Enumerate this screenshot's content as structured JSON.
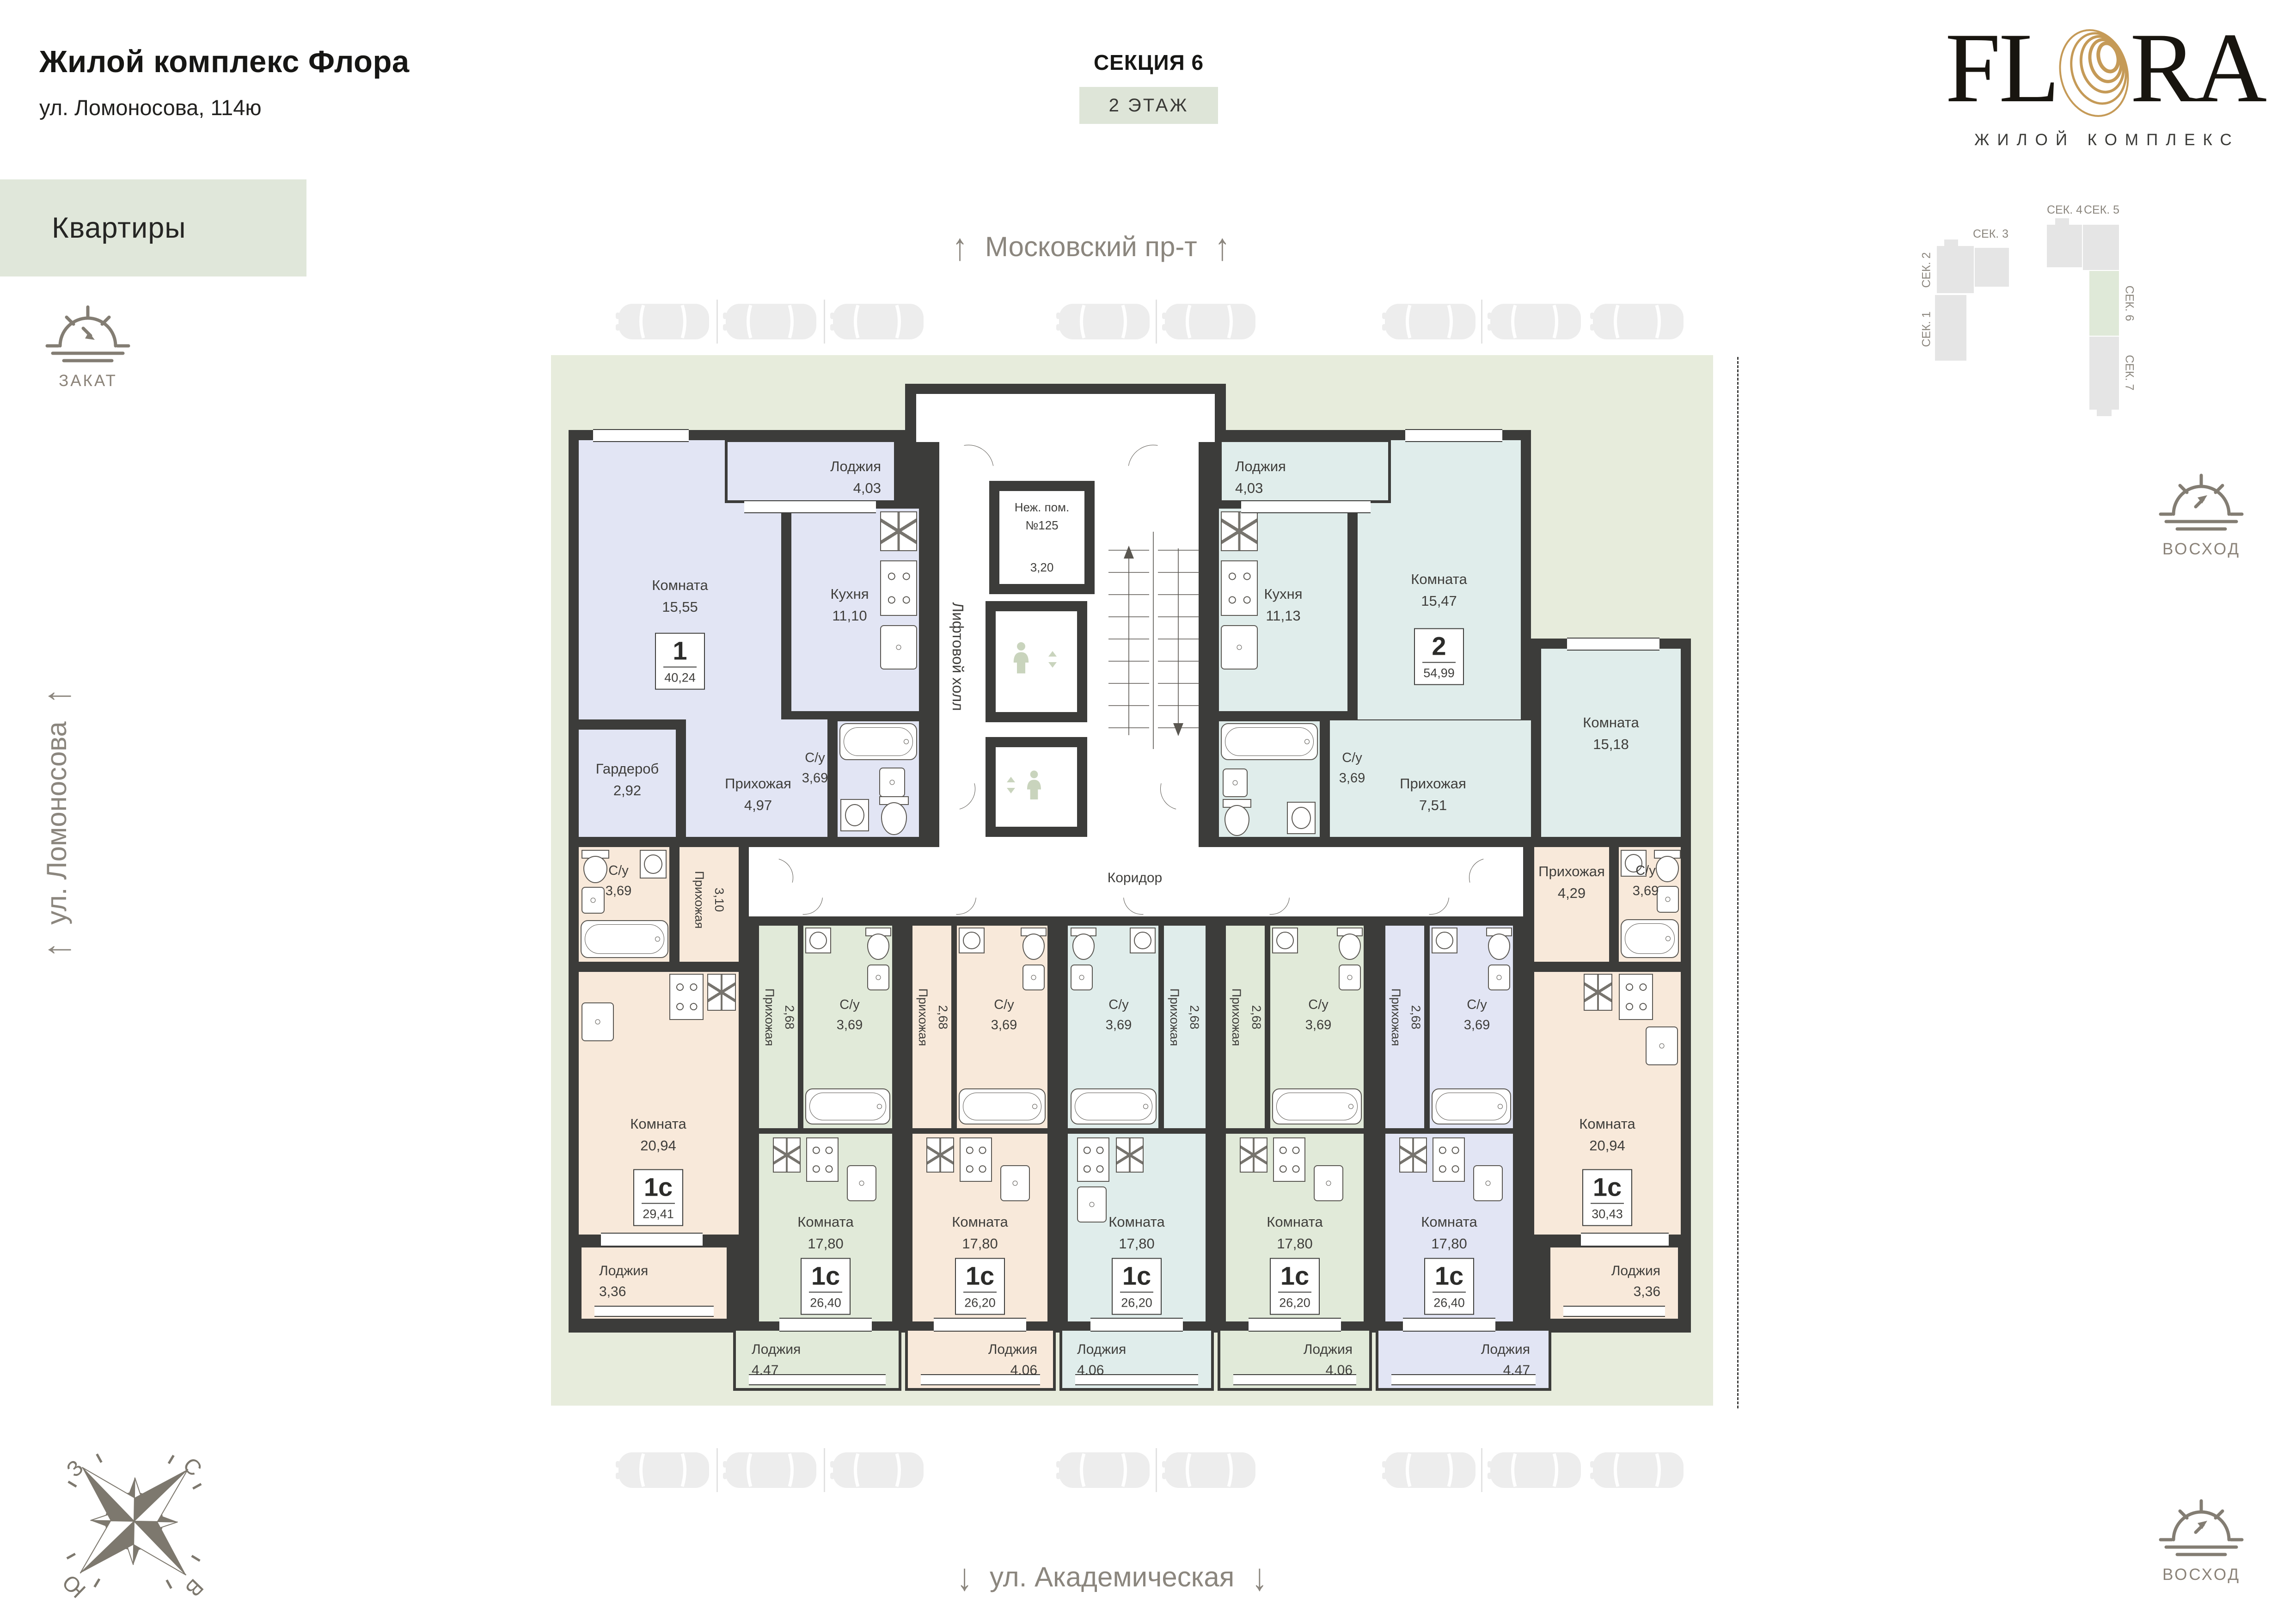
{
  "header": {
    "title": "Жилой комплекс Флора",
    "address": "ул. Ломоносова, 114ю",
    "section": "СЕКЦИЯ 6",
    "floor": "2 ЭТАЖ"
  },
  "logo": {
    "part1": "FL",
    "part2": "RA",
    "subtitle": "ЖИЛОЙ КОМПЛЕКС",
    "gold": "#c59a57"
  },
  "nav": {
    "apartments": "Квартиры"
  },
  "sun": {
    "sunset": "ЗАКАТ",
    "sunrise": "ВОСХОД"
  },
  "streets": {
    "top": "Московский пр-т",
    "bottom": "ул. Академическая",
    "left": "ул. Ломоносова",
    "arrow_up": "↑",
    "arrow_down": "↓"
  },
  "compass": {
    "n": "С",
    "e": "В",
    "s": "Ю",
    "w": "З"
  },
  "site_map": {
    "sec1": "СЕК. 1",
    "sec2": "СЕК. 2",
    "sec3": "СЕК. 3",
    "sec4": "СЕК. 4",
    "sec5": "СЕК. 5",
    "sec6": "СЕК. 6",
    "sec7": "СЕК. 7",
    "active": "СЕК. 6"
  },
  "core": {
    "elevator_hall": "Лифтовой холл",
    "nonres_line1": "Неж. пом.",
    "nonres_line2": "№125",
    "nonres_area": "3,20",
    "corridor": "Коридор"
  },
  "colors": {
    "wall": "#3c3c3a",
    "sage": "#e7ecdc",
    "lavender": "#e2e5f4",
    "teal": "#e0edeb",
    "peach": "#f8e9da",
    "green": "#e1ead9",
    "street": "#8b867e"
  },
  "apartments": {
    "a1": {
      "type": "1",
      "total": "40,24",
      "room": {
        "name": "Комната",
        "area": "15,55"
      },
      "kitchen": {
        "name": "Кухня",
        "area": "11,10"
      },
      "wardrobe": {
        "name": "Гардероб",
        "area": "2,92"
      },
      "hall": {
        "name": "Прихожая",
        "area": "4,97"
      },
      "wc": {
        "name": "С/у",
        "area": "3,69"
      },
      "loggia": {
        "name": "Лоджия",
        "area": "4,03"
      }
    },
    "a2": {
      "type": "2",
      "total": "54,99",
      "kitchen": {
        "name": "Кухня",
        "area": "11,13"
      },
      "room1": {
        "name": "Комната",
        "area": "15,47"
      },
      "room2": {
        "name": "Комната",
        "area": "15,18"
      },
      "hall": {
        "name": "Прихожая",
        "area": "7,51"
      },
      "wc": {
        "name": "С/у",
        "area": "3,69"
      },
      "loggia": {
        "name": "Лоджия",
        "area": "4,03"
      }
    },
    "b1": {
      "type": "1с",
      "total": "29,41",
      "room": {
        "name": "Комната",
        "area": "20,94"
      },
      "hall": {
        "name": "Прихожая",
        "area": "3,10"
      },
      "wc": {
        "name": "С/у",
        "area": "3,69"
      },
      "loggia": {
        "name": "Лоджия",
        "area": "3,36"
      }
    },
    "b2": {
      "type": "1с",
      "total": "26,40",
      "room": {
        "name": "Комната",
        "area": "17,80"
      },
      "hall": {
        "name": "Прихожая",
        "area": "2,68"
      },
      "wc": {
        "name": "С/у",
        "area": "3,69"
      },
      "loggia": {
        "name": "Лоджия",
        "area": "4,47"
      }
    },
    "b3": {
      "type": "1с",
      "total": "26,20",
      "room": {
        "name": "Комната",
        "area": "17,80"
      },
      "hall": {
        "name": "Прихожая",
        "area": "2,68"
      },
      "wc": {
        "name": "С/у",
        "area": "3,69"
      },
      "loggia": {
        "name": "Лоджия",
        "area": "4,06"
      }
    },
    "b4": {
      "type": "1с",
      "total": "26,20",
      "room": {
        "name": "Комната",
        "area": "17,80"
      },
      "hall": {
        "name": "Прихожая",
        "area": "2,68"
      },
      "wc": {
        "name": "С/у",
        "area": "3,69"
      },
      "loggia": {
        "name": "Лоджия",
        "area": "4,06"
      }
    },
    "b5": {
      "type": "1с",
      "total": "26,20",
      "room": {
        "name": "Комната",
        "area": "17,80"
      },
      "hall": {
        "name": "Прихожая",
        "area": "2,68"
      },
      "wc": {
        "name": "С/у",
        "area": "3,69"
      },
      "loggia": {
        "name": "Лоджия",
        "area": "4,06"
      }
    },
    "b6": {
      "type": "1с",
      "total": "26,40",
      "room": {
        "name": "Комната",
        "area": "17,80"
      },
      "hall": {
        "name": "Прихожая",
        "area": "2,68"
      },
      "wc": {
        "name": "С/у",
        "area": "3,69"
      },
      "loggia": {
        "name": "Лоджия",
        "area": "4,47"
      }
    },
    "b7": {
      "type": "1с",
      "total": "30,43",
      "room": {
        "name": "Комната",
        "area": "20,94"
      },
      "hall": {
        "name": "Прихожая",
        "area": "4,29"
      },
      "wc": {
        "name": "С/у",
        "area": "3,69"
      },
      "loggia": {
        "name": "Лоджия",
        "area": "3,36"
      }
    }
  }
}
